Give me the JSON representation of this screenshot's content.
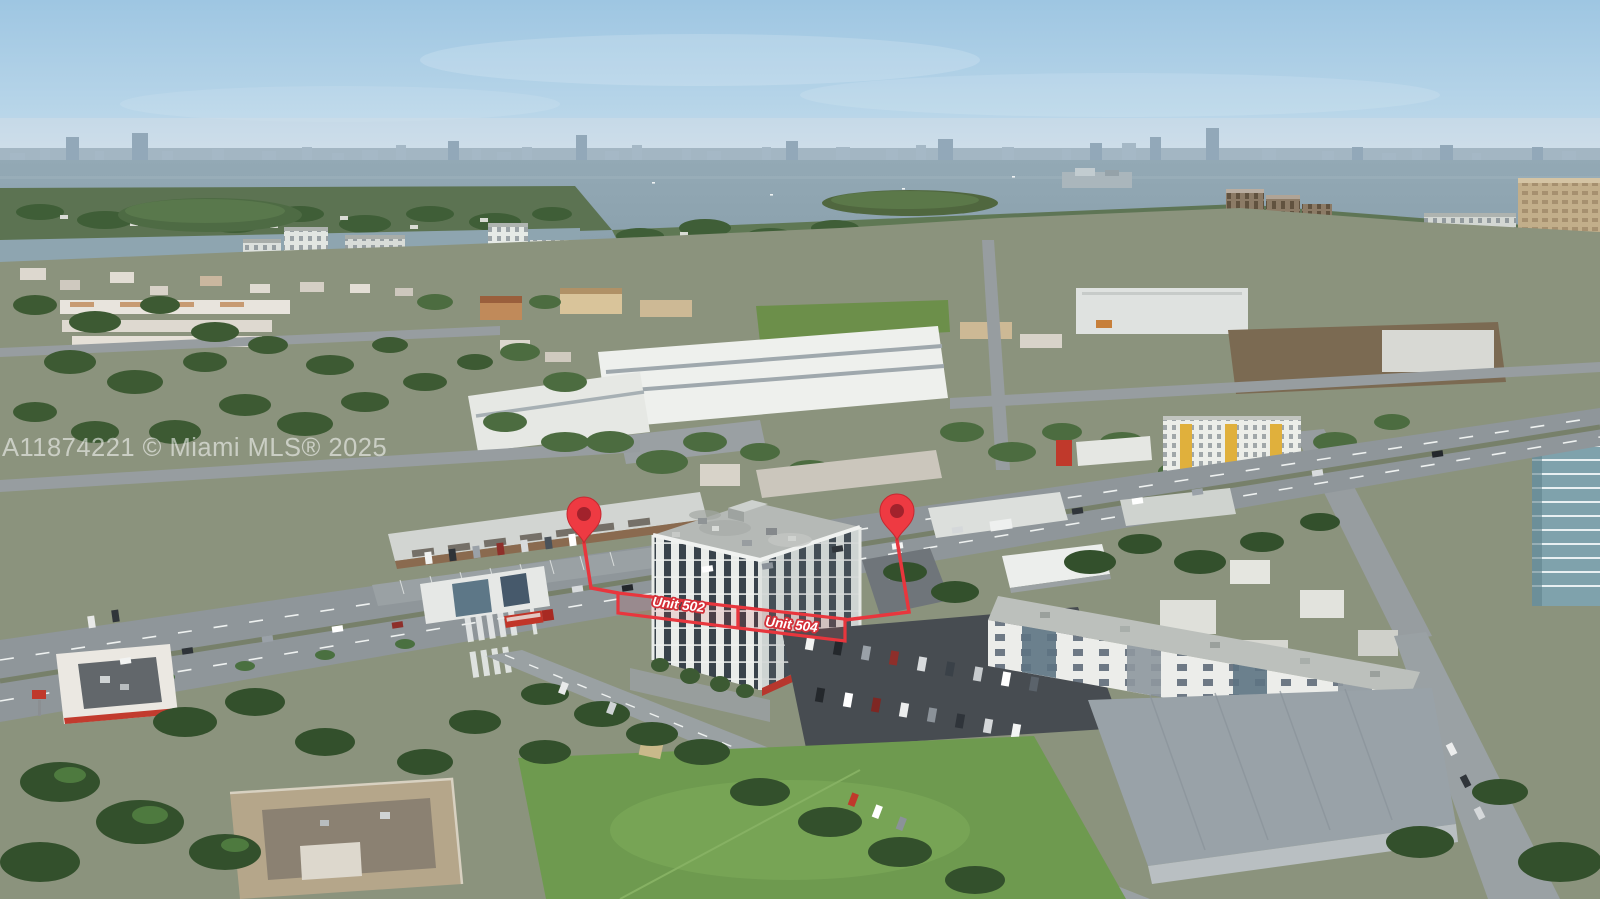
{
  "photo": {
    "kind": "aerial-drone-photo",
    "caption": "Aerial view of a bayfront Miami neighborhood; a white seven-story condo building is outlined in red with two map pins marking listed units",
    "sky_color": "#a8cbe3",
    "water_color": "#8aa1ad",
    "annotation_red": "#e8363d"
  },
  "watermark": {
    "text": "A11874221 © Miami MLS® 2025",
    "color": "#ffffff",
    "opacity": 0.55
  },
  "annotations": {
    "units": [
      {
        "label": "Unit 502"
      },
      {
        "label": "Unit 504"
      }
    ],
    "pins": [
      "map-pin-left",
      "map-pin-right"
    ]
  }
}
